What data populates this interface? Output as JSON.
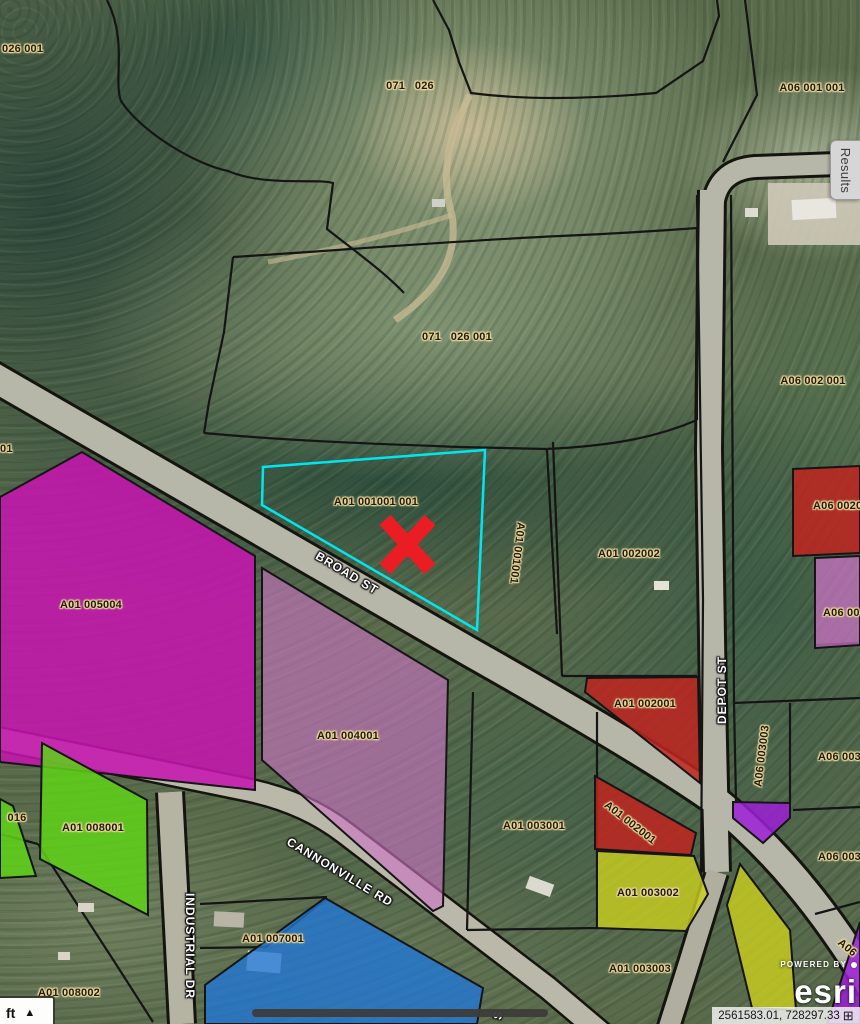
{
  "map": {
    "selected_parcel_id": "A01 001001 001",
    "parcel_labels": [
      {
        "t": "026 001",
        "x": 2,
        "y": 49,
        "r": 0,
        "a": "l"
      },
      {
        "t": "01",
        "x": 0,
        "y": 449,
        "r": 0,
        "a": "l"
      },
      {
        "t": "071   026",
        "x": 410,
        "y": 86,
        "r": 0
      },
      {
        "t": "071   026 001",
        "x": 457,
        "y": 337,
        "r": 0
      },
      {
        "t": "A06 001 001",
        "x": 812,
        "y": 88,
        "r": 0
      },
      {
        "t": "A06 002 001",
        "x": 813,
        "y": 381,
        "r": 0
      },
      {
        "t": "A01 001001 001",
        "x": 376,
        "y": 502,
        "r": 0
      },
      {
        "t": "A01 001001",
        "x": 517,
        "y": 553,
        "r": 97
      },
      {
        "t": "A01 002002",
        "x": 629,
        "y": 554,
        "r": 0
      },
      {
        "t": "A06 0020",
        "x": 813,
        "y": 506,
        "r": 0,
        "a": "l"
      },
      {
        "t": "A06 00",
        "x": 823,
        "y": 613,
        "r": 0,
        "a": "l"
      },
      {
        "t": "A01 005004",
        "x": 91,
        "y": 605,
        "r": 0
      },
      {
        "t": "A01 004001",
        "x": 348,
        "y": 736,
        "r": 0
      },
      {
        "t": "A01 002001",
        "x": 645,
        "y": 704,
        "r": 0
      },
      {
        "t": "A01 002001",
        "x": 630,
        "y": 823,
        "r": 38
      },
      {
        "t": "A01 003001",
        "x": 534,
        "y": 826,
        "r": 0
      },
      {
        "t": "A01 003002",
        "x": 648,
        "y": 893,
        "r": 0
      },
      {
        "t": "A01 003003",
        "x": 640,
        "y": 969,
        "r": 0
      },
      {
        "t": "A06 003003",
        "x": 762,
        "y": 756,
        "r": -83
      },
      {
        "t": "A06 003",
        "x": 818,
        "y": 757,
        "r": 0,
        "a": "l"
      },
      {
        "t": "A06 003",
        "x": 818,
        "y": 857,
        "r": 0,
        "a": "l"
      },
      {
        "t": "A01 008001",
        "x": 93,
        "y": 828,
        "r": 0
      },
      {
        "t": "016",
        "x": 17,
        "y": 818,
        "r": 0
      },
      {
        "t": "A01 008002",
        "x": 69,
        "y": 993,
        "r": 0
      },
      {
        "t": "A01 007001",
        "x": 273,
        "y": 939,
        "r": 0
      },
      {
        "t": "A06",
        "x": 847,
        "y": 948,
        "r": 40
      }
    ],
    "street_labels": [
      {
        "t": "BROAD ST",
        "x": 347,
        "y": 573,
        "r": 31
      },
      {
        "t": "CANNONVILLE RD",
        "x": 340,
        "y": 872,
        "r": 31
      },
      {
        "t": "DEPOT ST",
        "x": 722,
        "y": 690,
        "r": -90
      },
      {
        "t": "INDUSTRIAL DR",
        "x": 190,
        "y": 946,
        "r": 90
      },
      {
        "t": "S",
        "x": 498,
        "y": 1015,
        "r": -75
      }
    ]
  },
  "widgets": {
    "results_tab": "Results",
    "units_label": "ft",
    "triangle": "▲",
    "coordinates": "2561583.01, 728297.33",
    "coord_icon": "⊞",
    "powered_by": "POWERED BY",
    "esri_logo": "esri"
  },
  "colors": {
    "magenta": "#c516ae",
    "orchid": "#cb72c4",
    "red": "#bf241e",
    "yellow": "#ccd01e",
    "green": "#5ed216",
    "blue": "#2277d4",
    "purple": "#9c1fd6",
    "selection_cyan": "#00e6f0",
    "marker_red": "#ea1c24",
    "road_fill": "#b7b7a9",
    "boundary": "#151515"
  }
}
